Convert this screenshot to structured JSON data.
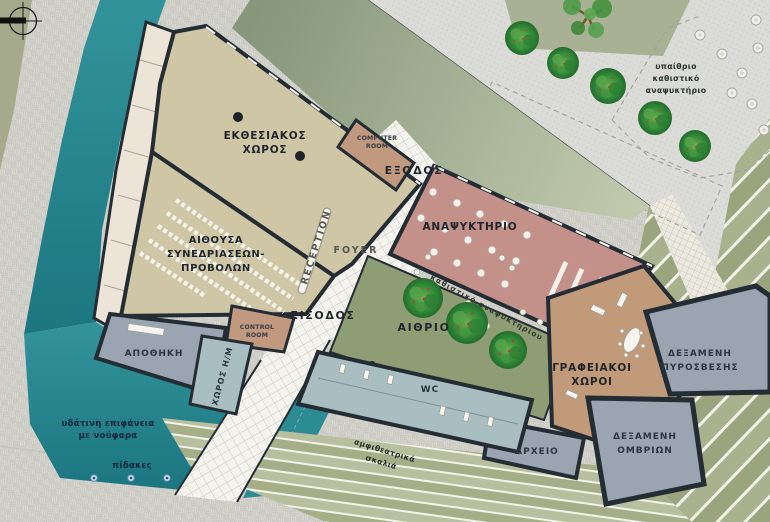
{
  "title": "Cultural building site plan",
  "colors": {
    "water": "#2b8c94",
    "water_deep": "#1b7680",
    "exhibition_beige": "#cec6a4",
    "ramp_cream": "#ece5d7",
    "refreshment_salmon": "#c4908a",
    "service_salmon": "#c0997f",
    "offices_tan": "#c19b79",
    "tank_gray": "#9aa5b1",
    "wc_blue": "#a9bec1",
    "atrium_green": "#8f9d74",
    "wedge_dark": "#87977c",
    "wedge_light": "#c3cbaf",
    "steps_green": "#a6ae88",
    "plaza_gray": "#dbdcd7",
    "pavement_gray": "#d3d3ce",
    "tile_white": "#f4f3ee",
    "wall_dark": "#232d33",
    "tree_green": "#2e8435",
    "label_dark": "#1f262b"
  },
  "rooms": {
    "exhibition": [
      "ΕΚΘΕΣΙΑΚΟΣ",
      "ΧΩΡΟΣ"
    ],
    "conference": [
      "ΑΙΘΟΥΣΑ",
      "ΣΥΝΕΔΡΙΑΣΕΩΝ-",
      "ΠΡΟΒΟΛΩΝ"
    ],
    "computer_room": [
      "COMPUTER",
      "ROOM"
    ],
    "control_room": [
      "CONTROL",
      "ROOM"
    ],
    "reception": "RECEPTION",
    "foyer": "FOYER",
    "exit": "ΕΞΟΔΟΣ",
    "entrance": "ΕΙΣΟΔΟΣ",
    "refreshment_bar": "ΑΝΑΨΥΚΤΗΡΙΟ",
    "atrium": "ΑΙΘΡΙΟ",
    "storage": "ΑΠΟΘΗΚΗ",
    "mech_room": "ΧΩΡΟΣ Η/Μ",
    "wc": "WC",
    "offices": [
      "ΓΡΑΦΕΙΑΚΟΙ",
      "ΧΩΡΟΙ"
    ],
    "fire_tank": [
      "ΔΕΞΑΜΕΝΗ",
      "ΠΥΡΟΣΒΕΣΗΣ"
    ],
    "rain_tank": [
      "ΔΕΞΑΜΕΝΗ",
      "ΟΜΒΡΙΩΝ"
    ],
    "archive": "ΑΡΧΕΙΟ"
  },
  "site": {
    "outdoor_cafe": [
      "υπαίθριο",
      "καθιστικό",
      "αναψυκτήριο"
    ],
    "water_lilies": [
      "υδάτινη επιφάνεια",
      "με νούφαρα"
    ],
    "jets": "πίδακες",
    "amphi_steps": [
      "αμφιθεατρικά",
      "σκαλιά"
    ],
    "cafe_seating": "καθιστικό αναψυκτηρίου"
  }
}
